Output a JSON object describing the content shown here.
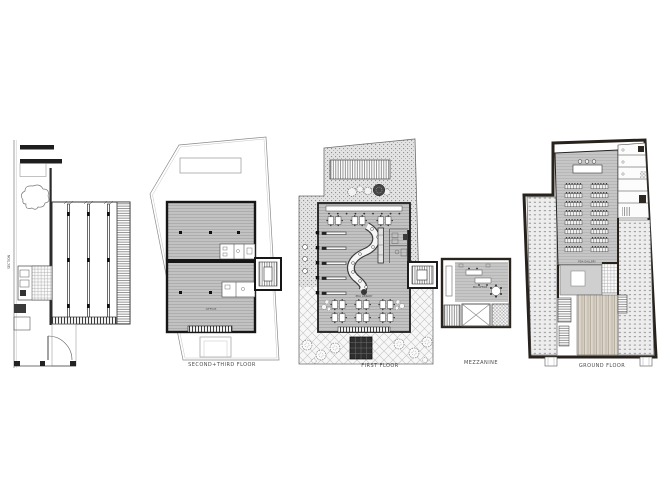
{
  "sheet": {
    "background": "#ffffff",
    "plans": {
      "section": {
        "caption": "SECTION"
      },
      "second_third_floor": {
        "caption": "SECOND+THIRD  FLOOR",
        "labels": {
          "office": "OFFICE"
        }
      },
      "first_floor": {
        "caption": "FIRST  FLOOR",
        "labels": {
          "library": "PDA  LIBRARY"
        }
      },
      "mezzanine": {
        "caption": "MEZZANINE",
        "labels": {
          "office": "PDA  OFFICE"
        }
      },
      "ground_floor": {
        "caption": "GROUND  FLOOR",
        "labels": {
          "gallery": "PDA  GALLERY"
        }
      }
    },
    "colors": {
      "wall_dark": "#27221c",
      "line": "#333333",
      "floor_gray": "#c2c2c2",
      "courtyard_stipple": "#e3e3e3",
      "paper": "#ffffff"
    }
  }
}
